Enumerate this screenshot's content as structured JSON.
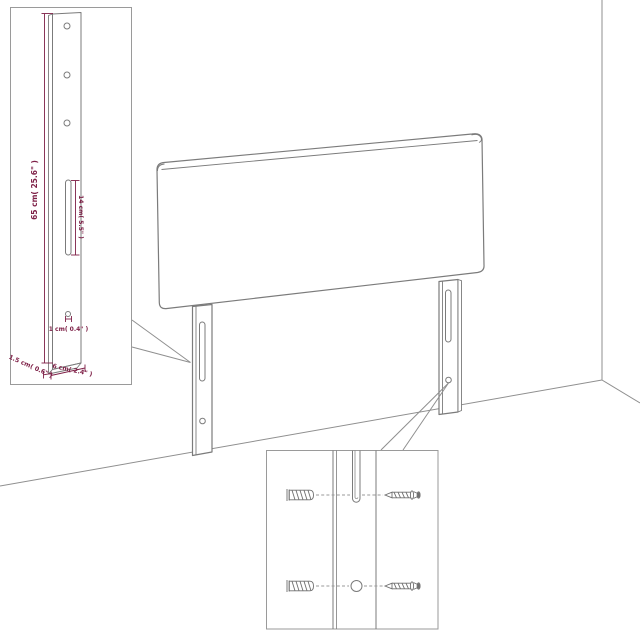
{
  "colors": {
    "background": "#ffffff",
    "line_art": "#7b7b7b",
    "wall_line": "#8f8f8f",
    "dimension": "#7e2047"
  },
  "leg_detail_inset": {
    "dim_height": "65 cm( 25.6\" )",
    "dim_slot": "14 cm( 5.5\" )",
    "dim_hole": "1 cm( 0.4\" )",
    "dim_depth": "1.5 cm( 0.6\" )",
    "dim_width": "6 cm( 2.4\" )"
  },
  "mounting_detail_inset": {
    "components": [
      "wall-plug",
      "screw",
      "slot",
      "hole"
    ]
  }
}
